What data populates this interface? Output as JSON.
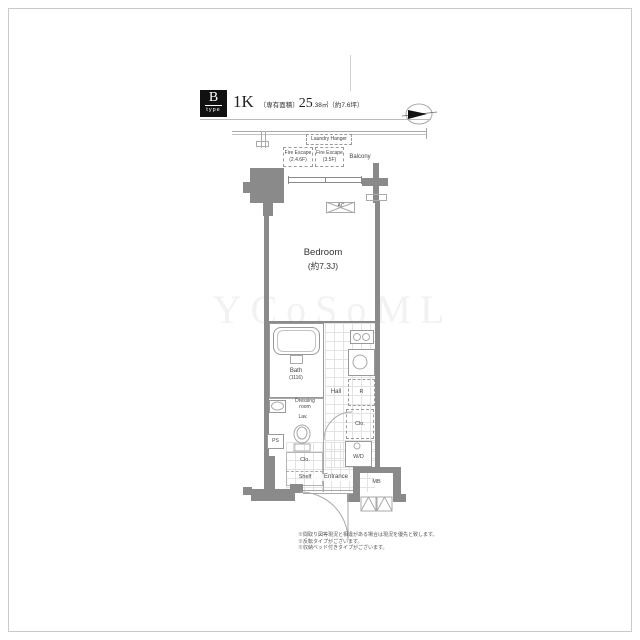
{
  "header": {
    "type_letter": "B",
    "type_word": "type",
    "layout_type": "1K",
    "area_prefix": "〔専有面積〕",
    "area_main": "25",
    "area_detail": ".38㎡（約7.6坪）"
  },
  "plan": {
    "balcony_zone": {
      "laundry_hanger": "Laundry Hanger",
      "fire_escape_1_line1": "Fire Escape",
      "fire_escape_1_line2": "(2.4.6F)",
      "fire_escape_2_line1": "Fire Escape",
      "fire_escape_2_line2": "(3.5F)",
      "balcony": "Balcony"
    },
    "rooms": {
      "ac": "AC",
      "bedroom_name": "Bedroom",
      "bedroom_size": "(約7.3J)",
      "bath_name": "Bath",
      "bath_size": "(1116)",
      "dressing_line1": "Dressing",
      "dressing_line2": "room",
      "lav": "Lav.",
      "hall": "Hall",
      "refrigerator": "R",
      "ps": "PS",
      "closet_left": "Clo.",
      "shelf": "Shelf",
      "entrance": "Entrance",
      "closet_right": "Clo.",
      "washer_dryer": "W/D",
      "meter_box": "MB"
    }
  },
  "notes": {
    "line1": "※間取り図等現況と相違がある場合は現況を優先と致します。",
    "line2": "※反転タイプがございます。",
    "line3": "※収納ベッド付きタイプがございます。"
  },
  "watermark": "YCoSoML",
  "colors": {
    "wall_gray": "#8a8a8a",
    "line_gray": "#a8a8a8",
    "badge_black": "#111111"
  }
}
